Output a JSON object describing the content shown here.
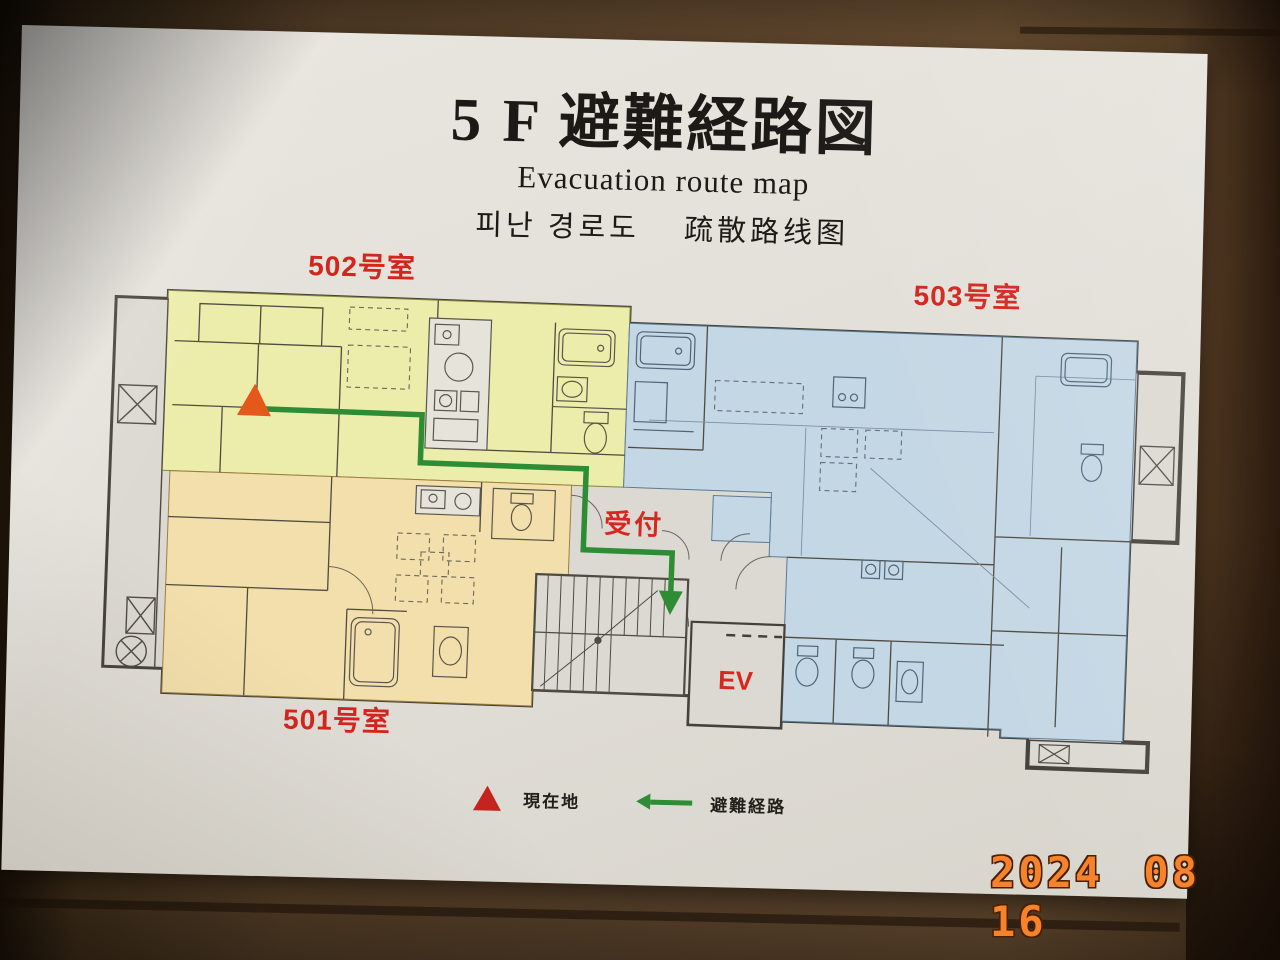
{
  "photo": {
    "date_stamp": "2024 08 16"
  },
  "poster": {
    "title": "5 F 避難経路図",
    "subtitle_en": "Evacuation route map",
    "subtitle_ko_zh": "피난 경로도　 疏散路线图",
    "rooms": {
      "r502": {
        "label": "502号室",
        "fill": "#ecedaa"
      },
      "r501": {
        "label": "501号室",
        "fill": "#f2dfab"
      },
      "r503": {
        "label": "503号室",
        "fill": "#c4d7e4"
      }
    },
    "map": {
      "reception_label": "受付",
      "elevator_label": "EV"
    },
    "legend": {
      "current_location": "現在地",
      "evacuation_route": "避難経路"
    },
    "colors": {
      "route_green": "#2e8c35",
      "current_location_marker": "#e4581c",
      "room_label_red": "#d2251c",
      "date_stamp_orange": "#f6832b"
    }
  }
}
